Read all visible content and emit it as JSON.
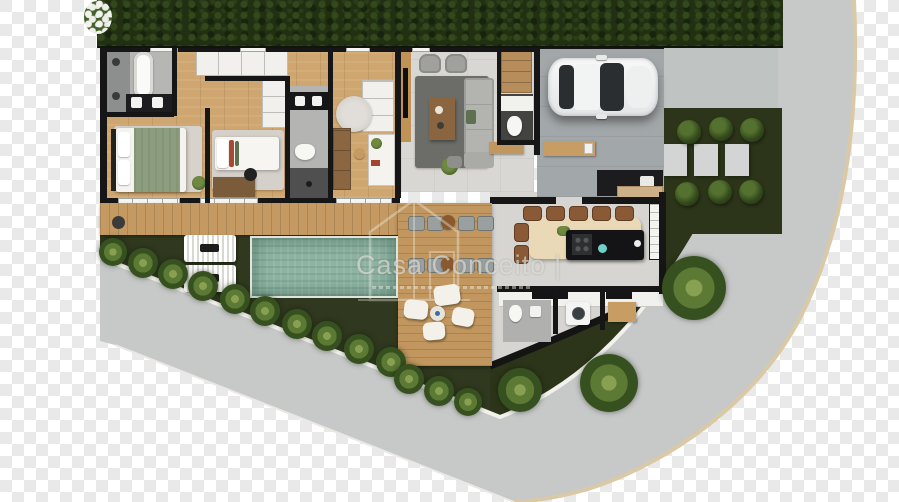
{
  "watermark": {
    "brand": "Casa Conceito",
    "separator": "|"
  },
  "scene": {
    "type": "floor-plan-render",
    "description": "Top-down 3D render of a single-story house on a curved corner lot with pool, transparent (checkerboard) background",
    "areas": [
      "top-hedge",
      "street-wrapping-corner",
      "driveway",
      "garage",
      "suite-bathroom",
      "master-bedroom",
      "bedroom-2",
      "bathroom-2",
      "bedroom-3-office",
      "living-room",
      "foyer",
      "powder-room",
      "kitchen",
      "dining-area",
      "pantry-shelves",
      "laundry",
      "service-bathroom",
      "covered-patio",
      "wood-walkway",
      "wood-deck",
      "swimming-pool",
      "pool-garden",
      "corner-garden-bed"
    ],
    "furniture": {
      "garage": [
        "white-car"
      ],
      "living_room": [
        "sofa",
        "two-armchairs",
        "coffee-table",
        "rug",
        "tv-panel",
        "floor-plant"
      ],
      "master_bedroom": [
        "double-bed-green-throw",
        "rug",
        "plant"
      ],
      "bedroom_2": [
        "single-bed",
        "rug",
        "desk",
        "chair",
        "wardrobe"
      ],
      "bedroom_3": [
        "round-rug",
        "wardrobe",
        "white-desk",
        "stool",
        "closet"
      ],
      "suite_bathroom": [
        "bathtub",
        "double-sink",
        "shower-drains"
      ],
      "bathroom_2": [
        "double-sink",
        "toilet",
        "shower"
      ],
      "powder_room": [
        "toilet",
        "vanity"
      ],
      "kitchen_dining": [
        "dining-table",
        "7-brown-chairs",
        "black-island-with-cooktop",
        "coffee-bar",
        "counter",
        "pantry"
      ],
      "laundry": [
        "counter",
        "washing-machine",
        "wood-bench",
        "toilet",
        "sink"
      ],
      "outdoor": [
        "two-sun-loungers",
        "two-outdoor-dining-sets",
        "lounge-cushions-set",
        "palm-plants",
        "round-bushes",
        "stepping-pavers"
      ]
    }
  },
  "palette": {
    "checker_light": "#ffffff",
    "checker_dark": "#e9e9e9",
    "hedge": "#223012",
    "grass": "#30391f",
    "wood_floor": "#cfa66f",
    "deck_wood": "#c2975f",
    "pool_water": "#8fb3a2",
    "street_concrete": "#c7c9c8",
    "driveway_concrete": "#bfc3c2",
    "garage_slab": "#a2a7a9",
    "curb_outer": "#d9c9a6",
    "curb_inner": "#f2f1ec",
    "walls": "#161616",
    "living_rug": "#6c6d68",
    "dining_table": "#ead9b6",
    "kitchen_island": "#141416",
    "chair_brown": "#8a5a36",
    "bed_blanket_green": "#8d9e80",
    "watermark": "rgba(236,236,230,0.6)"
  }
}
